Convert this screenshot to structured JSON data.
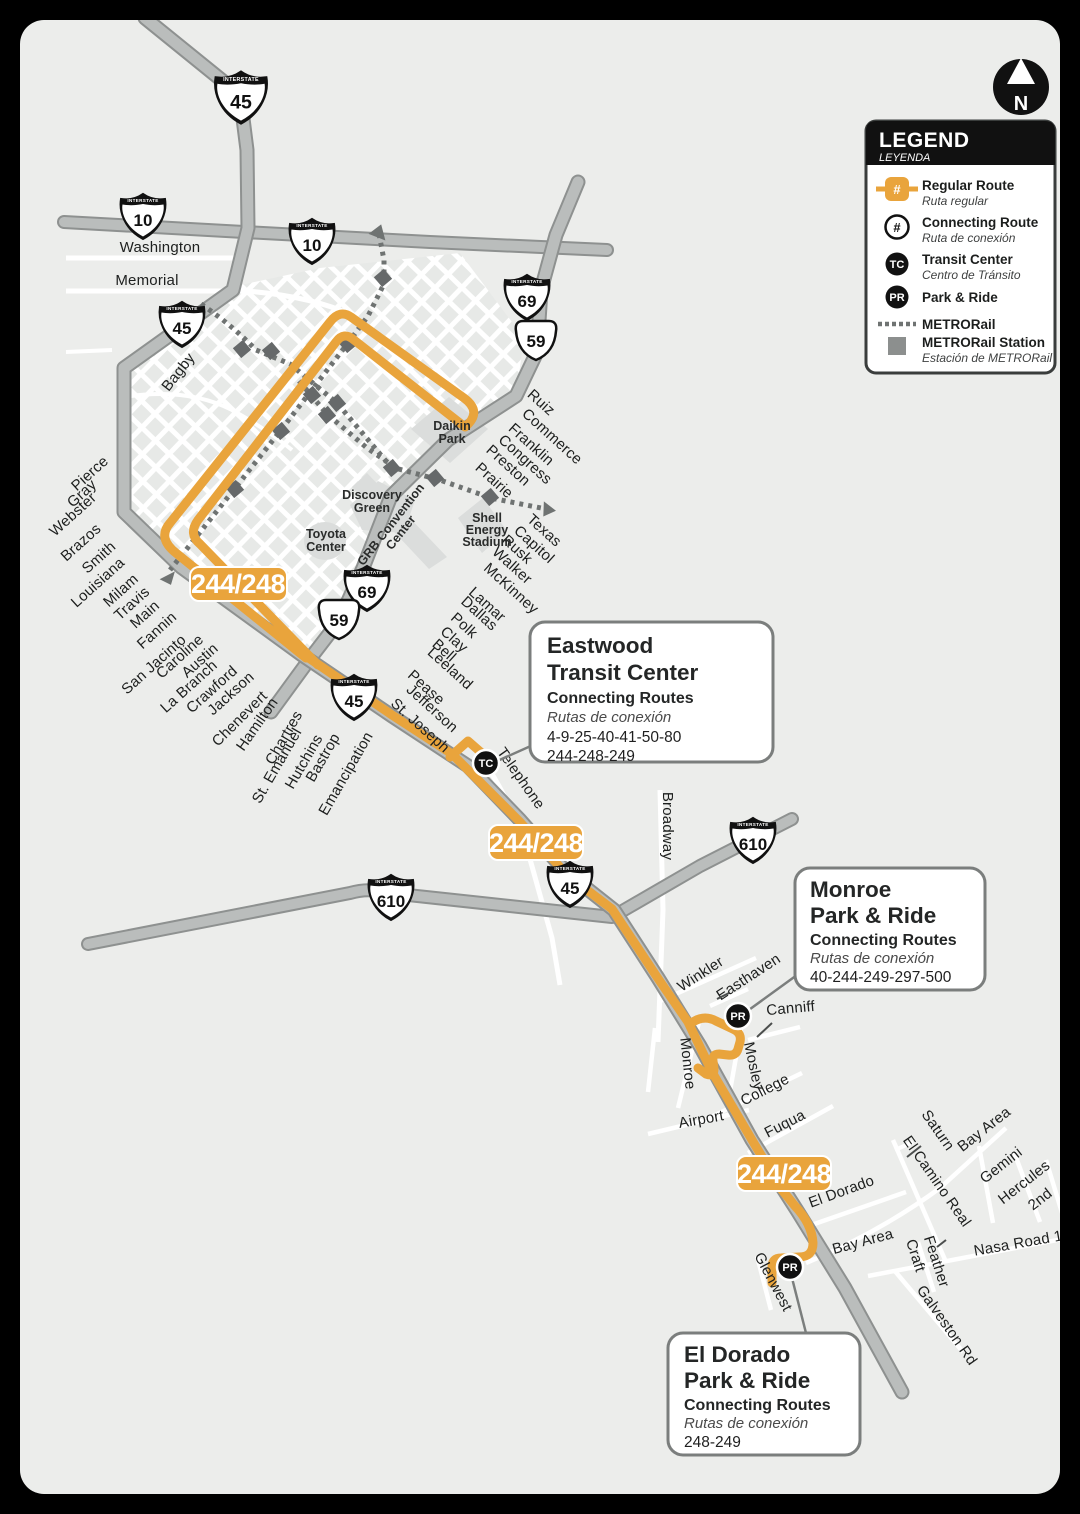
{
  "route_badge": "244/248",
  "north_label": "N",
  "markers": {
    "tc": "TC",
    "pr": "PR"
  },
  "shields": {
    "interstate": "INTERSTATE",
    "i45": "45",
    "i10": "10",
    "i69": "69",
    "us59": "59",
    "i610": "610"
  },
  "legend": {
    "title": "LEGEND",
    "subtitle": "LEYENDA",
    "hash": "#",
    "items": [
      {
        "label": "Regular Route",
        "sub": "Ruta regular"
      },
      {
        "label": "Connecting Route",
        "sub": "Ruta de conexión"
      },
      {
        "label": "Transit Center",
        "sub": "Centro de Tránsito"
      },
      {
        "label": "Park & Ride",
        "sub": ""
      },
      {
        "label": "METRORail",
        "sub": ""
      },
      {
        "label": "METRORail Station",
        "sub": "Estación de METRORail"
      }
    ]
  },
  "streets": [
    "Washington",
    "Memorial",
    "Bagby",
    "Pierce",
    "Gray",
    "Webster",
    "Brazos",
    "Smith",
    "Louisiana",
    "Milam",
    "Travis",
    "Main",
    "Fannin",
    "San Jacinto",
    "Caroline",
    "Austin",
    "La Branch",
    "Crawford",
    "Jackson",
    "Chenevert",
    "Hamilton",
    "Chartres",
    "St. Emanuel",
    "Hutchins",
    "Bastrop",
    "Emancipation",
    "Ruiz",
    "Commerce",
    "Franklin",
    "Congress",
    "Preston",
    "Prairie",
    "Texas",
    "Capitol",
    "Rusk",
    "Walker",
    "McKinney",
    "Lamar",
    "Dallas",
    "Polk",
    "Clay",
    "Bell",
    "Leeland",
    "Pease",
    "Jefferson",
    "St. Joseph",
    "Telephone",
    "Broadway",
    "Winkler",
    "Easthaven",
    "Canniff",
    "Monroe",
    "Mosley",
    "College",
    "Airport",
    "Fuqua",
    "El Dorado",
    "Bay Area",
    "Glenwest",
    "Saturn",
    "Bay Area",
    "El Camino Real",
    "Gemini",
    "Hercules",
    "2nd",
    "Feather",
    "Craft",
    "Nasa Road 1",
    "Galveston Rd"
  ],
  "landmarks": {
    "daikin": [
      "Daikin",
      "Park"
    ],
    "discovery": [
      "Discovery",
      "Green"
    ],
    "toyota": [
      "Toyota",
      "Center"
    ],
    "grb": [
      "GRB Convention",
      "Center"
    ],
    "shell": [
      "Shell",
      "Energy",
      "Stadium"
    ]
  },
  "callouts": {
    "eastwood": {
      "title1": "Eastwood",
      "title2": "Transit Center",
      "heading": "Connecting Routes",
      "heading_es": "Rutas de conexión",
      "routes1": "4-9-25-40-41-50-80",
      "routes2": "244-248-249"
    },
    "monroe": {
      "title1": "Monroe",
      "title2": "Park & Ride",
      "heading": "Connecting Routes",
      "heading_es": "Rutas de conexión",
      "routes1": "40-244-249-297-500"
    },
    "eldorado": {
      "title1": "El Dorado",
      "title2": "Park & Ride",
      "heading": "Connecting Routes",
      "heading_es": "Rutas de conexión",
      "routes1": "248-249"
    }
  },
  "colors": {
    "route": "#E9A43C",
    "freeway": "#BABDBC",
    "freeway_casing": "#8E9190",
    "rail": "#6F7372",
    "map_bg": "#ECEDEB",
    "frame": "#000000"
  }
}
